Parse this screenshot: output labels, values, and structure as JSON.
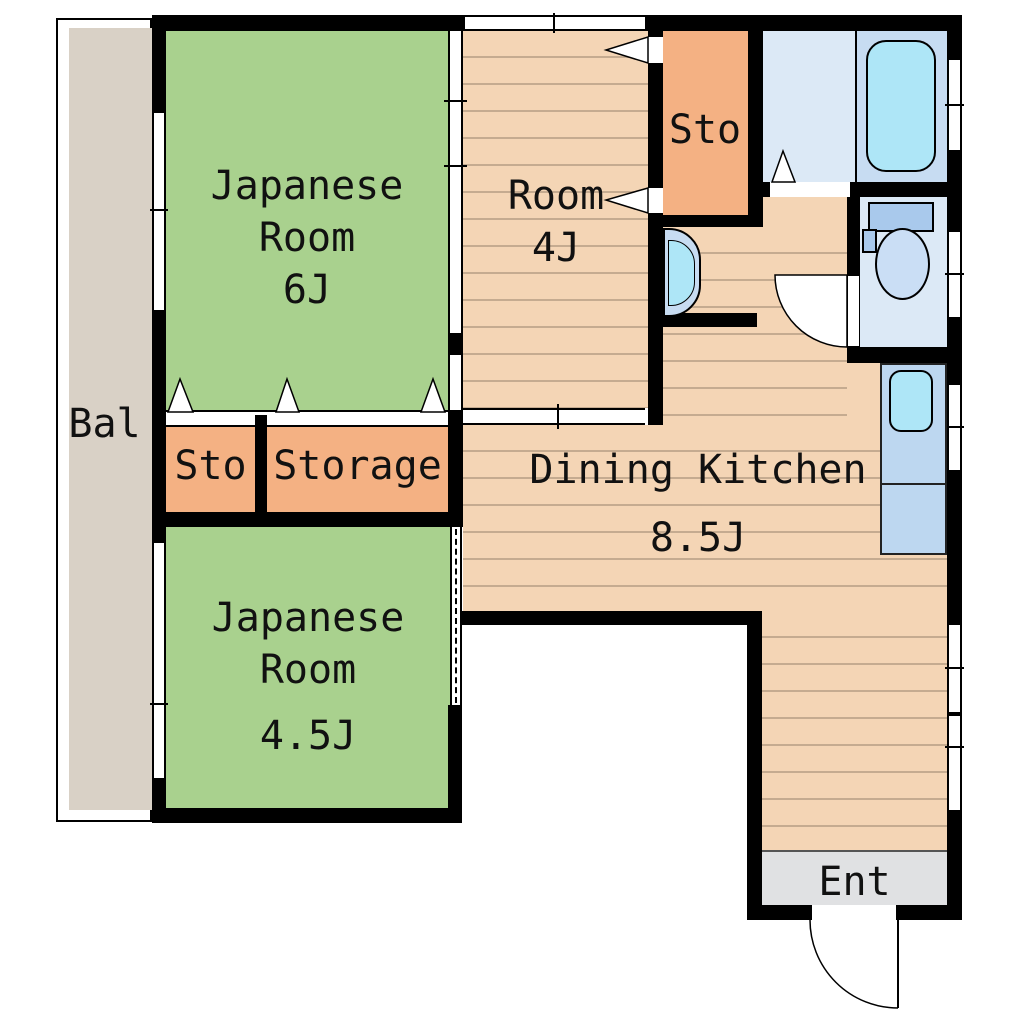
{
  "labels": {
    "jp6": [
      "Japanese",
      "Room",
      "6J"
    ],
    "room4": [
      "Room",
      "4J"
    ],
    "jp45": [
      "Japanese",
      "Room",
      "4.5J"
    ],
    "dk": [
      "Dining Kitchen",
      "8.5J"
    ],
    "sto_upper": "Sto",
    "sto_lower": "Sto",
    "storage": "Storage",
    "balcony": "Bal",
    "entrance": "Ent"
  },
  "rooms": [
    {
      "name": "Japanese Room",
      "area": "6J",
      "type": "tatami"
    },
    {
      "name": "Room",
      "area": "4J",
      "type": "flooring"
    },
    {
      "name": "Japanese Room",
      "area": "4.5J",
      "type": "tatami"
    },
    {
      "name": "Dining Kitchen",
      "area": "8.5J",
      "type": "flooring"
    },
    {
      "name": "Sto",
      "type": "closet"
    },
    {
      "name": "Sto",
      "type": "closet"
    },
    {
      "name": "Storage",
      "type": "closet"
    },
    {
      "name": "Bal",
      "type": "balcony"
    },
    {
      "name": "Ent",
      "type": "entrance"
    }
  ],
  "fixtures": [
    "bathtub",
    "toilet",
    "washbasin",
    "kitchen-sink-counter",
    "entrance-door",
    "toilet-door",
    "washroom-door"
  ],
  "colors": {
    "tatami_green": "#a9d18e",
    "floor_tan": "#f4d5b5",
    "closet_orange": "#f4b183",
    "balcony_gray": "#d9d1c6",
    "wet_room_blue": "#dce9f6",
    "bath_blue": "#c7dcf2",
    "fixture_cyan": "#aee6f7",
    "counter_blue": "#bdd7f0",
    "toilet_tank_blue": "#a9c9ec",
    "toilet_bowl_blue": "#cadef5",
    "entrance_gray": "#e0e1e3",
    "wall_black": "#000000",
    "hatch_line": "#b3a291"
  }
}
